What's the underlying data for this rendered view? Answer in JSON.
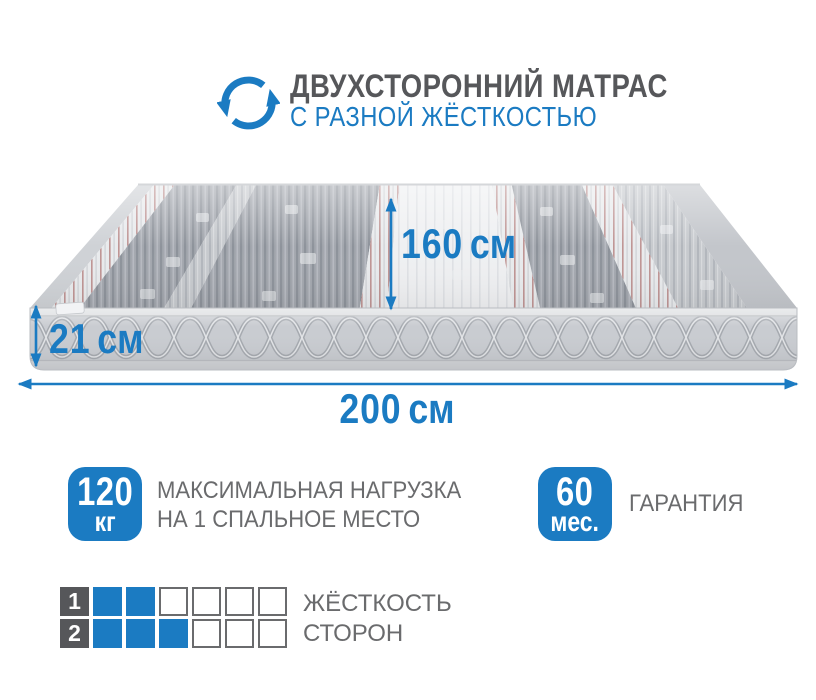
{
  "header": {
    "icon": "rotate-arrows-icon",
    "title": "ДВУХСТОРОННИЙ МАТРАС",
    "subtitle": "С РАЗНОЙ ЖЁСТКОСТЬЮ"
  },
  "dimensions": {
    "depth": {
      "value": "160",
      "unit": "см"
    },
    "height": {
      "value": "21",
      "unit": "см"
    },
    "length": {
      "value": "200",
      "unit": "см"
    }
  },
  "badges": {
    "max_load": {
      "value": "120",
      "unit": "кг",
      "label_line1": "МАКСИМАЛЬНАЯ НАГРУЗКА",
      "label_line2": "НА 1 СПАЛЬНОЕ МЕСТО"
    },
    "warranty": {
      "value": "60",
      "unit": "мес.",
      "label": "ГАРАНТИЯ"
    }
  },
  "firmness": {
    "label_line1": "ЖЁСТКОСТЬ",
    "label_line2": "СТОРОН",
    "scale_max": 6,
    "sides": [
      {
        "side": "1",
        "filled": 2
      },
      {
        "side": "2",
        "filled": 3
      }
    ]
  },
  "colors": {
    "accent_blue": "#1b7bc2",
    "title_gray": "#56575a",
    "text_gray": "#6a6b6d",
    "square_gray": "#56575a",
    "outline_gray": "#6a6b6d"
  }
}
